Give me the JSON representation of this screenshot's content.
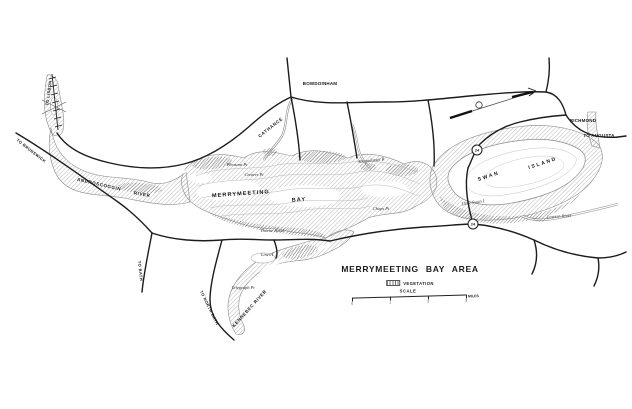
{
  "map": {
    "title": "MERRYMEETING BAY AREA",
    "legend": {
      "vegetation_label": "VEGETATION",
      "scale_label": "SCALE",
      "scale_ticks": [
        "0",
        "1",
        "2",
        "3"
      ],
      "miles_label": "MILES"
    },
    "colors": {
      "ink": "#1b1b1b",
      "water_outline": "#8a8a8a",
      "vegetation_hatch": "#9b9b9b",
      "dark_marsh_hatch": "#6e6e6e",
      "background": "#ffffff"
    },
    "icons": {
      "north_arrow": "north-arrow",
      "vegetation_swatch": "hatched-box"
    },
    "route_shields": [
      {
        "number": "24",
        "x": 477,
        "y": 150
      },
      {
        "number": "24",
        "x": 473,
        "y": 224
      }
    ],
    "labels": [
      {
        "text": "MERRYMEETING",
        "x": 241,
        "y": 195,
        "rot": -4,
        "cls": "bay"
      },
      {
        "text": "BAY",
        "x": 299,
        "y": 201,
        "rot": -4,
        "cls": "bay"
      },
      {
        "text": "SWAN",
        "x": 489,
        "y": 177,
        "rot": -18,
        "cls": "island"
      },
      {
        "text": "ISLAND",
        "x": 543,
        "y": 164,
        "rot": -18,
        "cls": "island"
      },
      {
        "text": "ANDROSCOGGIN",
        "x": 99,
        "y": 185,
        "rot": 13,
        "cls": "river"
      },
      {
        "text": "RIVER",
        "x": 142,
        "y": 195,
        "rot": 9,
        "cls": "river"
      },
      {
        "text": "CATHANCE",
        "x": 271,
        "y": 128,
        "rot": -38,
        "cls": "river"
      },
      {
        "text": "KENNEBEC RIVER",
        "x": 250,
        "y": 309,
        "rot": -48,
        "cls": "river"
      },
      {
        "text": "BOWDOINHAM",
        "x": 320,
        "y": 84,
        "rot": 0,
        "cls": "place"
      },
      {
        "text": "RICHMOND",
        "x": 583,
        "y": 121,
        "rot": 0,
        "cls": "place"
      },
      {
        "text": "TO AUGUSTA",
        "x": 599,
        "y": 136,
        "rot": 0,
        "cls": "place"
      },
      {
        "text": "TO LISBON",
        "x": 49,
        "y": 93,
        "rot": -82,
        "cls": "roadlabel"
      },
      {
        "text": "TO BRUNSWICK",
        "x": 31,
        "y": 151,
        "rot": 38,
        "cls": "roadlabel"
      },
      {
        "text": "TO BATH",
        "x": 140,
        "y": 271,
        "rot": 84,
        "cls": "roadlabel"
      },
      {
        "text": "TO NORTH BATH",
        "x": 209,
        "y": 308,
        "rot": 64,
        "cls": "roadlabel"
      },
      {
        "text": "Abagadasset R",
        "x": 371,
        "y": 161,
        "rot": -6,
        "cls": "water"
      },
      {
        "text": "Eastern River",
        "x": 559,
        "y": 217,
        "rot": -4,
        "cls": "water"
      },
      {
        "text": "Pleasant Pt",
        "x": 237,
        "y": 165,
        "rot": 0,
        "cls": "water"
      },
      {
        "text": "Centers Pt",
        "x": 254,
        "y": 175,
        "rot": 0,
        "cls": "water"
      },
      {
        "text": "Chops Pt",
        "x": 381,
        "y": 209,
        "rot": 0,
        "cls": "water"
      },
      {
        "text": "Lines I",
        "x": 267,
        "y": 255,
        "rot": 0,
        "cls": "water"
      },
      {
        "text": "Telegraph Pt",
        "x": 243,
        "y": 288,
        "rot": 0,
        "cls": "water"
      },
      {
        "text": "Little Swan I",
        "x": 473,
        "y": 203,
        "rot": -8,
        "cls": "water"
      },
      {
        "text": "Thorne Head",
        "x": 272,
        "y": 231,
        "rot": 0,
        "cls": "water"
      }
    ]
  }
}
